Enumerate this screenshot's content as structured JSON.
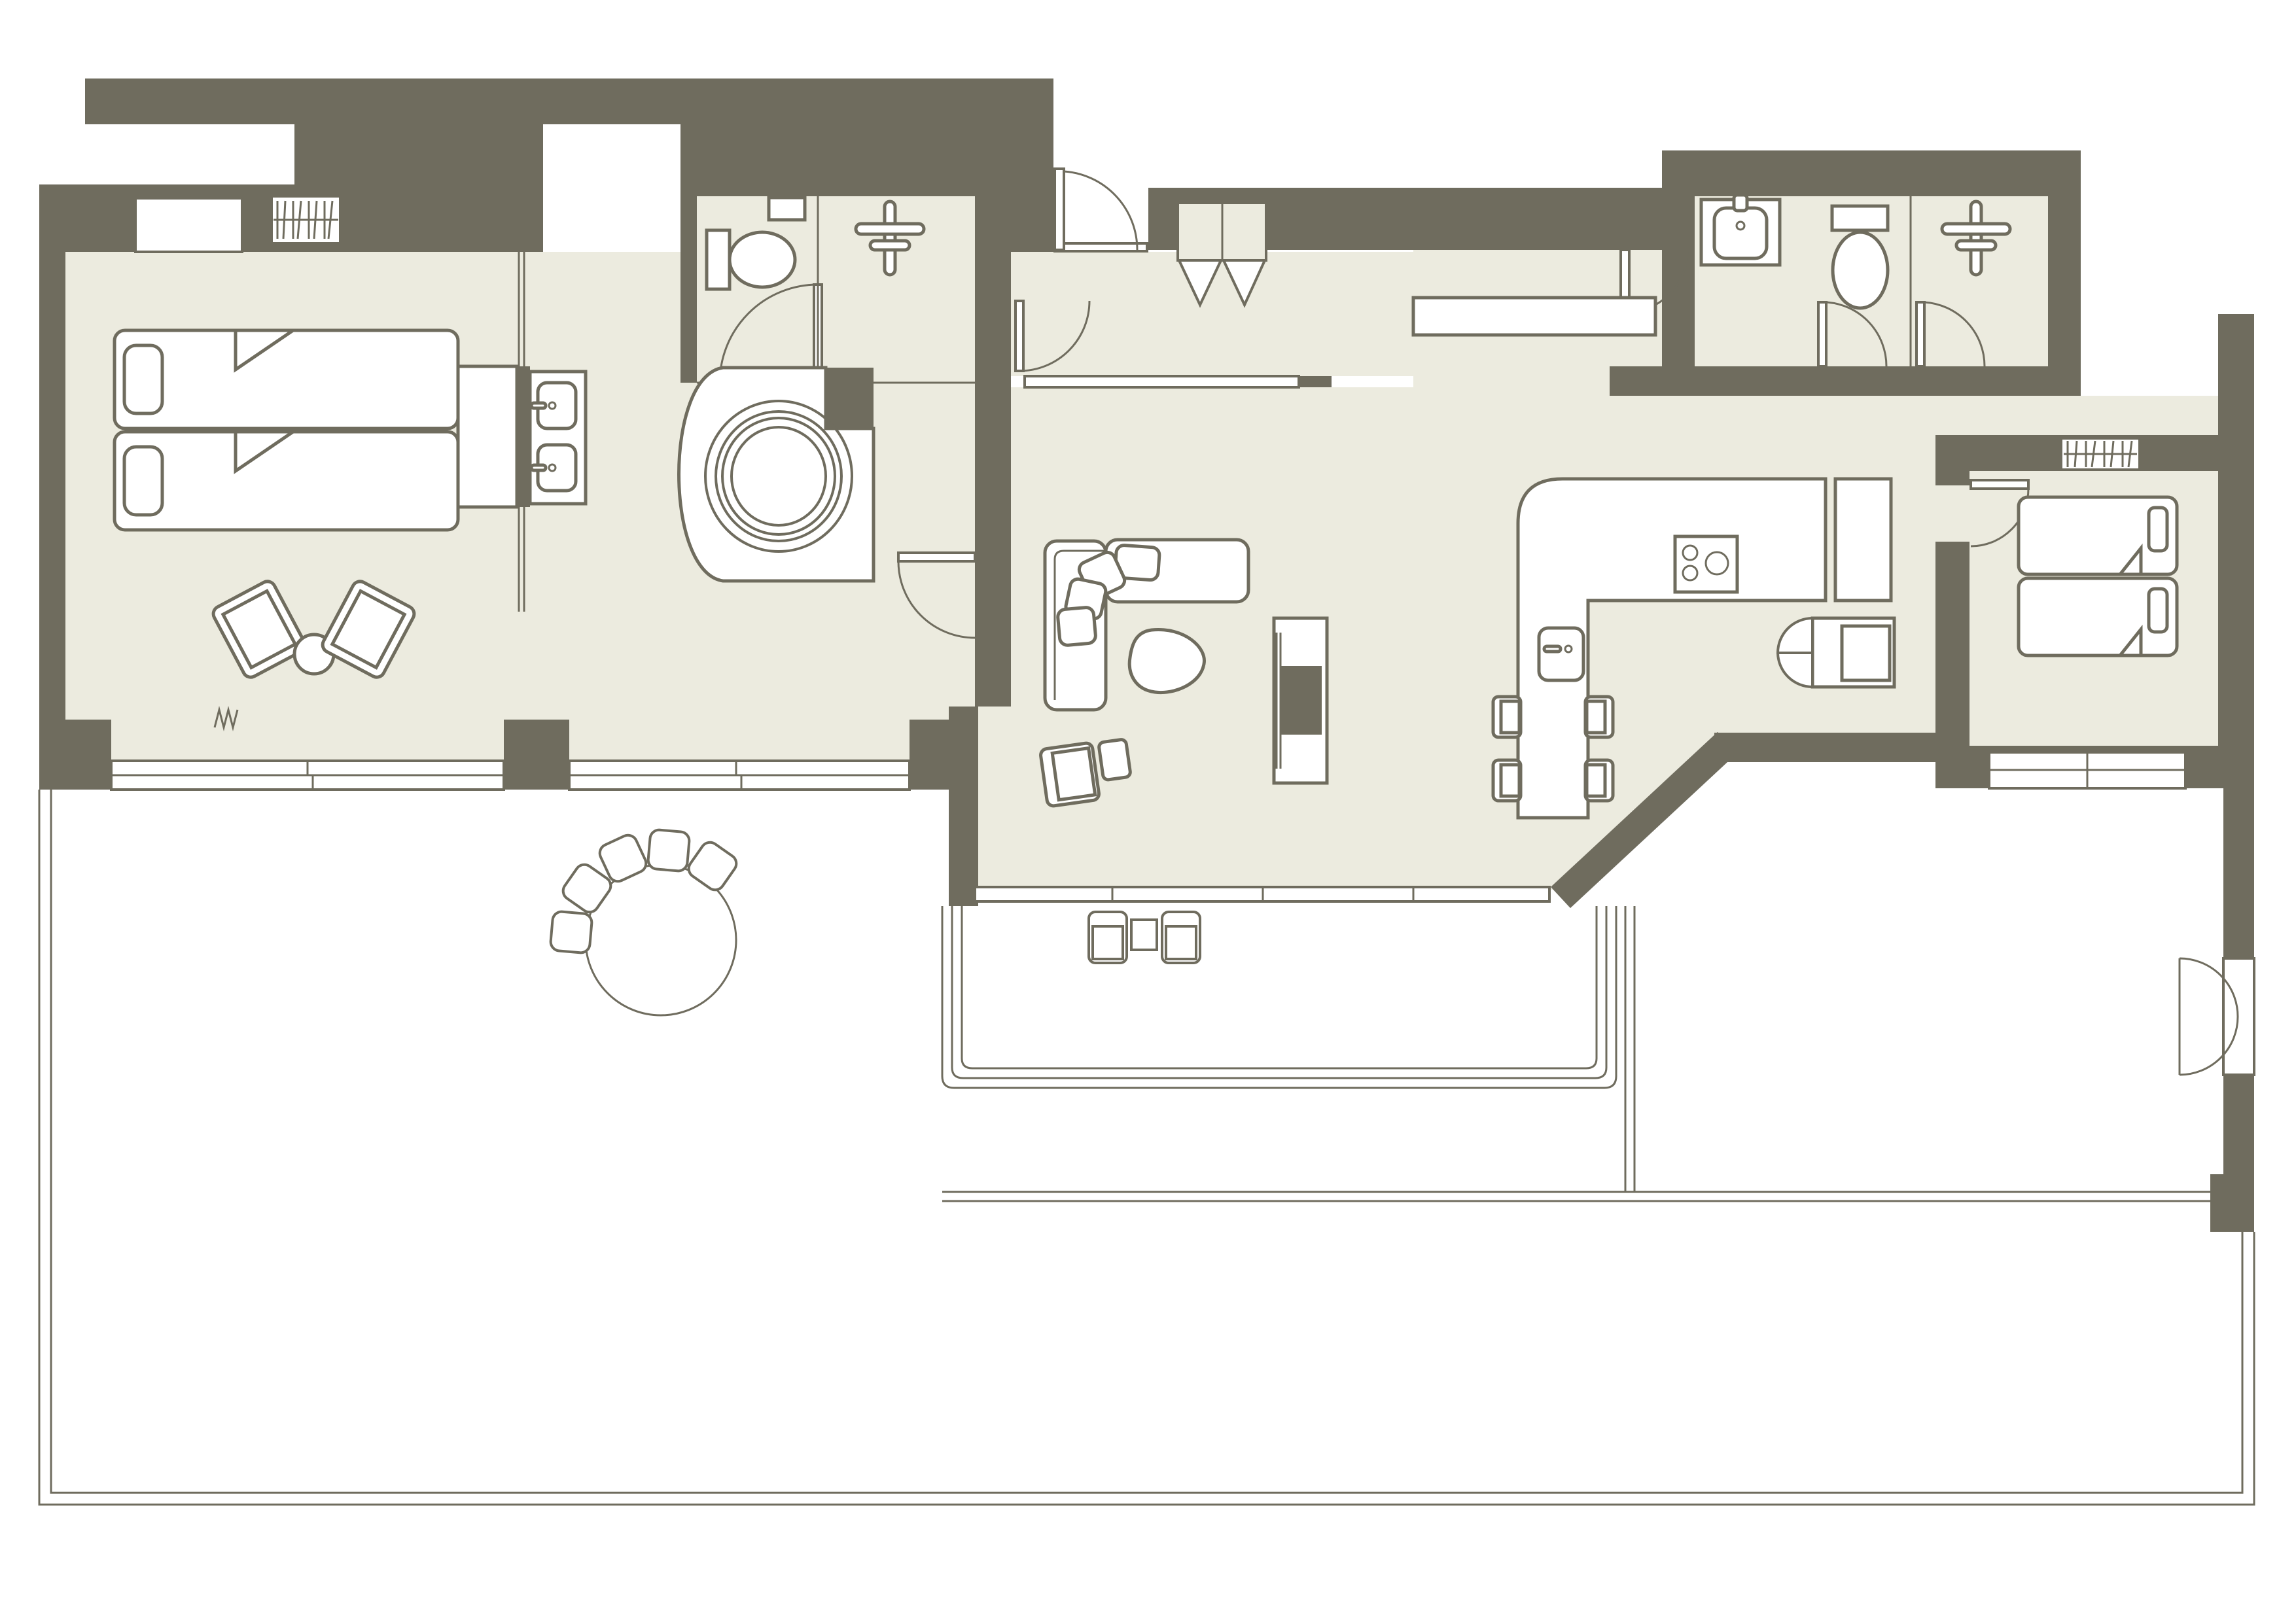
{
  "title": "apartment-floor-plan",
  "colors": {
    "background": "#FFFFFF",
    "wall": "#6F6C5E",
    "floor": "#ECEBDF",
    "line": "#6F6C5E",
    "fixture": "#FFFFFF"
  },
  "rooms": [
    {
      "name": "bedroom-left",
      "fixtures": [
        "twin-bed-1",
        "twin-bed-2",
        "pillows",
        "folded-blanket-corners",
        "accent-chair-1",
        "accent-chair-2",
        "round-side-table",
        "wardrobe",
        "radiator",
        "wall-niche",
        "sliding-windows",
        "vent-zigzag"
      ]
    },
    {
      "name": "bathroom-left",
      "fixtures": [
        "double-sink-vanity",
        "round-bathtub",
        "tub-platform",
        "glass-partition",
        "exit-door"
      ]
    },
    {
      "name": "wc-left",
      "fixtures": [
        "toilet",
        "wall-shelf",
        "door"
      ]
    },
    {
      "name": "shower-left",
      "fixtures": [
        "shower-head-symbol"
      ]
    },
    {
      "name": "entry-hall",
      "fixtures": [
        "entry-door",
        "door-sill",
        "bifold-closet",
        "hall-door",
        "threshold-strip"
      ]
    },
    {
      "name": "living-dining",
      "fixtures": [
        "l-sofa",
        "sofa-cushions",
        "organic-coffee-table",
        "armchair",
        "ottoman",
        "tv-console",
        "wall-counter",
        "sliding-door-track"
      ]
    },
    {
      "name": "kitchen",
      "fixtures": [
        "l-counter",
        "cooktop",
        "island-sink",
        "bar-chair-1",
        "bar-chair-2",
        "bar-chair-3",
        "bar-chair-4",
        "tall-cabinet",
        "pantry-bifold"
      ]
    },
    {
      "name": "corridor-right",
      "fixtures": [
        "corridor-door"
      ]
    },
    {
      "name": "bathroom-right-1",
      "fixtures": [
        "vanity-sink",
        "toilet",
        "door"
      ]
    },
    {
      "name": "bathroom-right-2",
      "fixtures": [
        "shower-head-symbol",
        "door"
      ]
    },
    {
      "name": "bedroom-right",
      "fixtures": [
        "twin-bed-1",
        "twin-bed-2",
        "pillows",
        "radiator",
        "window",
        "door"
      ]
    },
    {
      "name": "terrace",
      "fixtures": [
        "round-dining-table",
        "curved-bench-cushions",
        "lounge-chair-1",
        "lounge-chair-2",
        "outdoor-side-table",
        "sunken-court-steps",
        "platform-steps",
        "french-doors",
        "boundary-railing"
      ]
    }
  ]
}
